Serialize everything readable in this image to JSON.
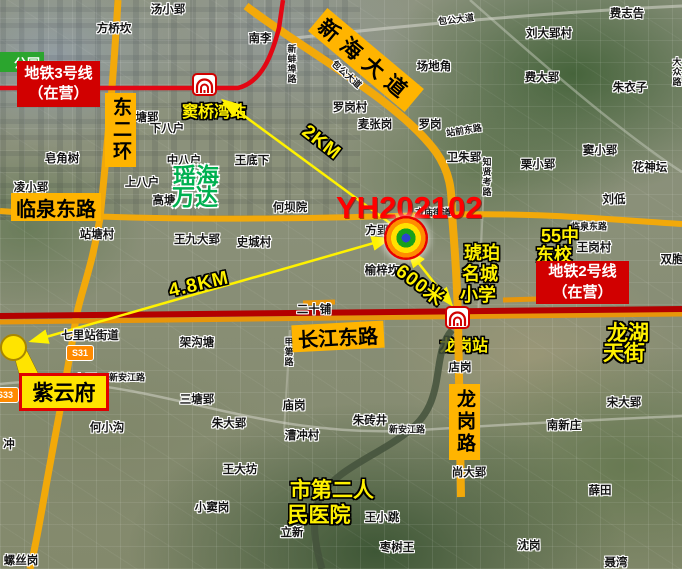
{
  "plot": {
    "id": "YH202102"
  },
  "metro_boxes": {
    "line3": {
      "line1": "地铁3号线",
      "line2": "（在营）"
    },
    "line2": {
      "line1": "地铁2号线",
      "line2": "（在营）"
    }
  },
  "road_boxes": {
    "dong_er_huan": "东二环",
    "linquan_east": "临泉东路",
    "xinhai_avenue": "新海大道",
    "changjiang_east": "长江东路",
    "longgang_road": "龙岗路"
  },
  "stations": {
    "douqiaowan": "窦桥湾站",
    "longgang": "龙岗站"
  },
  "callout": {
    "ziyunfu": "紫云府"
  },
  "park_label": "公园",
  "badges": {
    "s31": "S31",
    "s33": "S33"
  },
  "distances": [
    {
      "t": "2KM",
      "x": 321,
      "y": 143,
      "r": 38
    },
    {
      "t": "4.8KM",
      "x": 199,
      "y": 285,
      "r": -13
    },
    {
      "t": "600米",
      "x": 421,
      "y": 284,
      "r": 37
    }
  ],
  "green_poi": [
    {
      "t": "瑶海",
      "x": 196,
      "y": 174
    },
    {
      "t": "万达",
      "x": 195,
      "y": 195
    }
  ],
  "yellow_poi": [
    {
      "t": "琥珀",
      "x": 482,
      "y": 252
    },
    {
      "t": "名城",
      "x": 480,
      "y": 273
    },
    {
      "t": "小学",
      "x": 478,
      "y": 294
    },
    {
      "t": "55中",
      "x": 560,
      "y": 235
    },
    {
      "t": "东校",
      "x": 554,
      "y": 254
    },
    {
      "t": "龙湖",
      "x": 628,
      "y": 332,
      "size": 21
    },
    {
      "t": "天街",
      "x": 624,
      "y": 352,
      "size": 21
    },
    {
      "t": "市第二人",
      "x": 332,
      "y": 489,
      "size": 21
    },
    {
      "t": "民医院",
      "x": 319,
      "y": 514,
      "size": 21
    }
  ],
  "map_labels": [
    {
      "t": "汤小郢",
      "x": 168,
      "y": 9
    },
    {
      "t": "方桥坎",
      "x": 114,
      "y": 28
    },
    {
      "t": "南李",
      "x": 260,
      "y": 38
    },
    {
      "t": "包公大道",
      "x": 456,
      "y": 19,
      "r": -7,
      "s": 1
    },
    {
      "t": "包公大道",
      "x": 347,
      "y": 74,
      "r": 42,
      "s": 1
    },
    {
      "t": "费志告",
      "x": 627,
      "y": 13
    },
    {
      "t": "刘大郢村",
      "x": 549,
      "y": 33
    },
    {
      "t": "场地角",
      "x": 434,
      "y": 66
    },
    {
      "t": "费大郢",
      "x": 542,
      "y": 77
    },
    {
      "t": "朱衣子",
      "x": 630,
      "y": 87
    },
    {
      "t": "大众路",
      "x": 677,
      "y": 72,
      "v": 1,
      "s": 1
    },
    {
      "t": "罗岗村",
      "x": 350,
      "y": 107
    },
    {
      "t": "麦张岗",
      "x": 375,
      "y": 124
    },
    {
      "t": "罗岗",
      "x": 430,
      "y": 124
    },
    {
      "t": "站前东路",
      "x": 464,
      "y": 130,
      "r": -9,
      "s": 1
    },
    {
      "t": "卫朱郢",
      "x": 464,
      "y": 157
    },
    {
      "t": "窦小郢",
      "x": 600,
      "y": 150
    },
    {
      "t": "栗小郢",
      "x": 538,
      "y": 164
    },
    {
      "t": "花神坛",
      "x": 650,
      "y": 167
    },
    {
      "t": "刘低",
      "x": 614,
      "y": 199
    },
    {
      "t": "塘郢",
      "x": 147,
      "y": 117
    },
    {
      "t": "下八户",
      "x": 167,
      "y": 128
    },
    {
      "t": "皂角树",
      "x": 62,
      "y": 158
    },
    {
      "t": "中八户",
      "x": 184,
      "y": 160
    },
    {
      "t": "上八户",
      "x": 142,
      "y": 182
    },
    {
      "t": "凌小郢",
      "x": 31,
      "y": 187
    },
    {
      "t": "高塘",
      "x": 164,
      "y": 200
    },
    {
      "t": "站塘村",
      "x": 97,
      "y": 234
    },
    {
      "t": "王九大郢",
      "x": 197,
      "y": 239
    },
    {
      "t": "王底下",
      "x": 252,
      "y": 160
    },
    {
      "t": "何坝院",
      "x": 290,
      "y": 207
    },
    {
      "t": "方郢",
      "x": 377,
      "y": 230
    },
    {
      "t": "史城村",
      "x": 254,
      "y": 242
    },
    {
      "t": "榆梓坎",
      "x": 382,
      "y": 270
    },
    {
      "t": "二十铺",
      "x": 314,
      "y": 309
    },
    {
      "t": "王岗村",
      "x": 594,
      "y": 247
    },
    {
      "t": "双胞",
      "x": 672,
      "y": 259
    },
    {
      "t": "七里站街道",
      "x": 90,
      "y": 335
    },
    {
      "t": "架沟塘",
      "x": 197,
      "y": 342
    },
    {
      "t": "方庙街道",
      "x": 433,
      "y": 212,
      "s": 1
    },
    {
      "t": "临泉东路",
      "x": 589,
      "y": 226,
      "s": 1
    },
    {
      "t": "新安江路",
      "x": 127,
      "y": 377,
      "s": 1
    },
    {
      "t": "小郢",
      "x": 85,
      "y": 379
    },
    {
      "t": "三塘郢",
      "x": 197,
      "y": 399
    },
    {
      "t": "朱大郢",
      "x": 229,
      "y": 423
    },
    {
      "t": "庙岗",
      "x": 294,
      "y": 405
    },
    {
      "t": "朱砖井",
      "x": 370,
      "y": 420
    },
    {
      "t": "新安江路",
      "x": 407,
      "y": 429,
      "s": 1
    },
    {
      "t": "漕冲村",
      "x": 302,
      "y": 435
    },
    {
      "t": "店岗",
      "x": 460,
      "y": 367
    },
    {
      "t": "宋大郢",
      "x": 624,
      "y": 402
    },
    {
      "t": "南新庄",
      "x": 564,
      "y": 425
    },
    {
      "t": "尚大郢",
      "x": 469,
      "y": 472
    },
    {
      "t": "王大坊",
      "x": 240,
      "y": 469
    },
    {
      "t": "小窦岗",
      "x": 212,
      "y": 507
    },
    {
      "t": "立新",
      "x": 292,
      "y": 532
    },
    {
      "t": "王小跳",
      "x": 382,
      "y": 517
    },
    {
      "t": "枣树王",
      "x": 397,
      "y": 547
    },
    {
      "t": "薛田",
      "x": 600,
      "y": 490
    },
    {
      "t": "沈岗",
      "x": 529,
      "y": 545
    },
    {
      "t": "聂湾",
      "x": 616,
      "y": 562
    },
    {
      "t": "螺丝岗",
      "x": 21,
      "y": 560
    },
    {
      "t": "何小沟",
      "x": 107,
      "y": 427
    },
    {
      "t": "冲",
      "x": 9,
      "y": 444
    },
    {
      "t": "新蚌埠路",
      "x": 292,
      "y": 64,
      "v": 1,
      "s": 1
    },
    {
      "t": "知贤考路",
      "x": 487,
      "y": 177,
      "v": 1,
      "s": 1
    },
    {
      "t": "甲第路",
      "x": 289,
      "y": 352,
      "v": 1,
      "s": 1
    }
  ]
}
